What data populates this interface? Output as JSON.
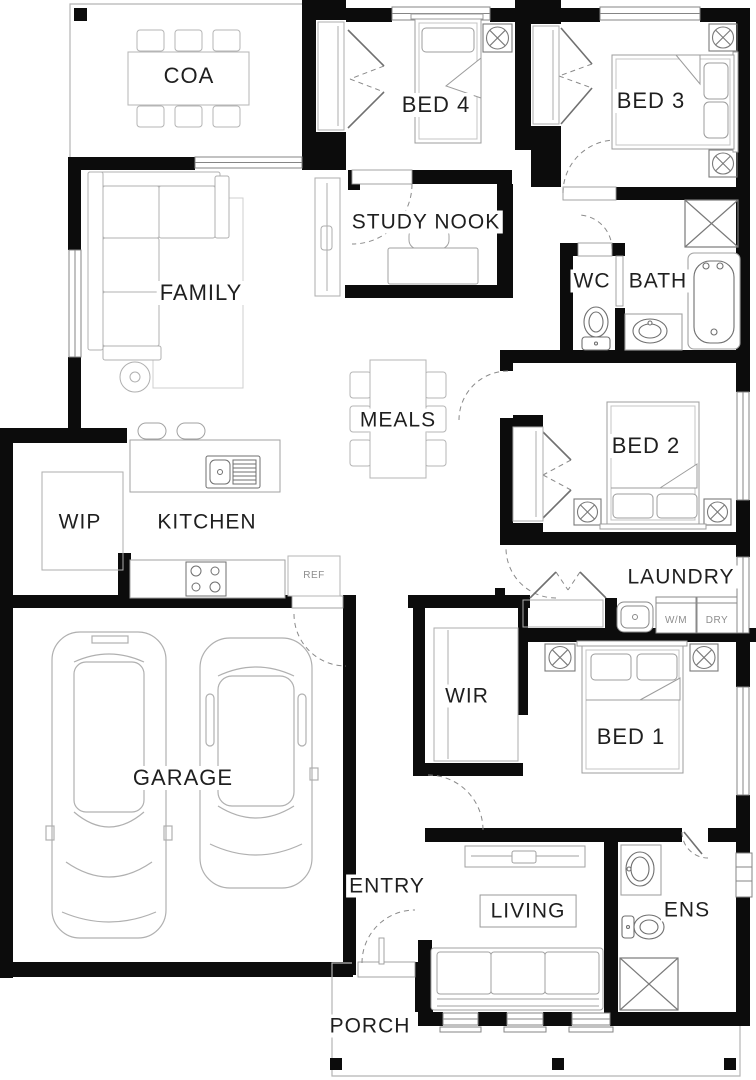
{
  "plan": {
    "rooms": {
      "coa": "COA",
      "bed4": "BED 4",
      "bed3": "BED 3",
      "study_nook": "STUDY NOOK",
      "family": "FAMILY",
      "wc": "WC",
      "bath": "BATH",
      "meals": "MEALS",
      "bed2": "BED 2",
      "wip": "WIP",
      "kitchen": "KITCHEN",
      "laundry": "LAUNDRY",
      "garage": "GARAGE",
      "wir": "WIR",
      "bed1": "BED 1",
      "entry": "ENTRY",
      "living": "LIVING",
      "ens": "ENS",
      "porch": "PORCH"
    },
    "appliances": {
      "fridge": "REF",
      "washing_machine": "W/M",
      "dryer": "DRY"
    },
    "colors": {
      "wall": "#0c0c0c",
      "furniture_line": "#adadad",
      "fixture_line": "#767676",
      "label_text": "#1f1f1f",
      "background": "#ffffff"
    }
  }
}
